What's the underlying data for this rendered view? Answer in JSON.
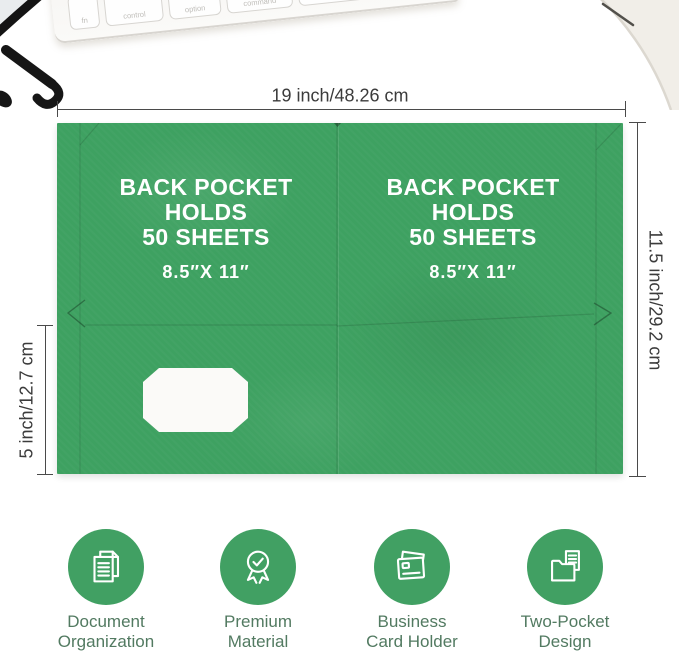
{
  "dimensions": {
    "width_label": "19 inch/48.26 cm",
    "height_label": "11.5 inch/29.2 cm",
    "pocket_depth_label": "5 inch/12.7 cm"
  },
  "folder": {
    "left_pocket": {
      "line1": "BACK POCKET",
      "line2": "HOLDS",
      "line3": "50 SHEETS",
      "sheet_size": "8.5″X 11″"
    },
    "right_pocket": {
      "line1": "BACK POCKET",
      "line2": "HOLDS",
      "line3": "50 SHEETS",
      "sheet_size": "8.5″X 11″"
    }
  },
  "features": [
    {
      "icon": "stacked-documents-icon",
      "label1": "Document",
      "label2": "Organization"
    },
    {
      "icon": "award-ribbon-icon",
      "label1": "Premium",
      "label2": "Material"
    },
    {
      "icon": "business-card-icon",
      "label1": "Business",
      "label2": "Card Holder"
    },
    {
      "icon": "two-pocket-folder-icon",
      "label1": "Two-Pocket",
      "label2": "Design"
    }
  ],
  "keyboard": {
    "keys": [
      "fn",
      "control",
      "option",
      "command"
    ]
  },
  "colors": {
    "folder_green": "#3EA161",
    "icon_green": "#41A063",
    "feature_label": "#527A61",
    "dimension_text": "#3B3B3B",
    "dimension_line": "#4A4A4A"
  }
}
